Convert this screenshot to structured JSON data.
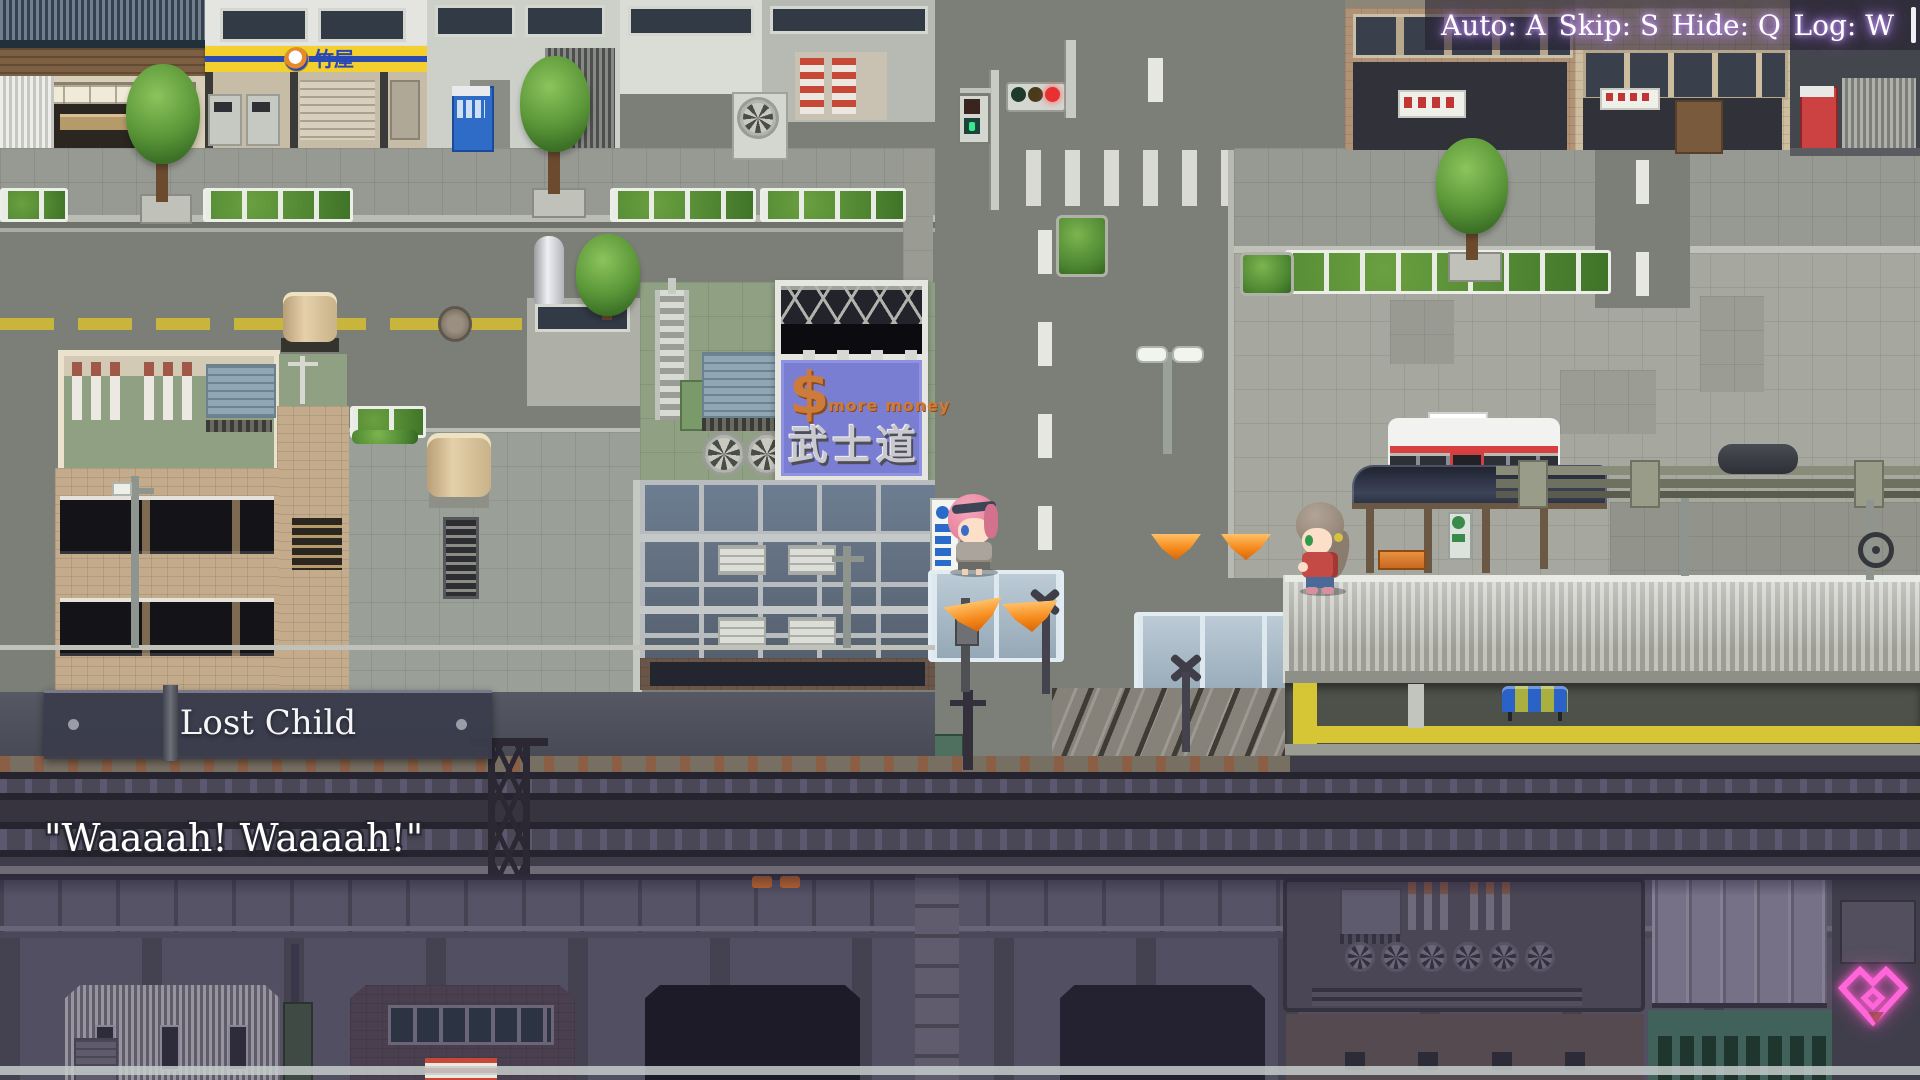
{
  "ui": {
    "quick_menu": {
      "items": [
        {
          "label": "Auto: A"
        },
        {
          "label": "Skip: S"
        },
        {
          "label": "Hide: Q"
        },
        {
          "label": "Log: W"
        }
      ]
    },
    "location_banner": {
      "title": "Lost Child"
    },
    "dialog": {
      "line": "\"Waaaah! Waaaah!\""
    },
    "continue_indicator": {
      "shape": "pink-heart-diamond",
      "color": "#ff66d9"
    }
  },
  "scene": {
    "billboard": {
      "dollar": "$",
      "tagline": "more money",
      "kanji": "武士道",
      "panel_color": "#7a7ed2",
      "text_color": "#cd7b3a"
    },
    "storefront_sign": {
      "text": "竹屋",
      "bg_color": "#f4d02e",
      "text_color": "#2847b8"
    },
    "path_markers": {
      "color": "#f58a1c",
      "count": 4
    },
    "characters": [
      {
        "name": "pink-haired-girl"
      },
      {
        "name": "lost-child-girl"
      }
    ],
    "station": {
      "tactile_line_color": "#d6c636",
      "traffic_light_state": "red"
    }
  },
  "colors": {
    "menu_glow": "#a97ae8",
    "banner_bg": "#3a3c4c",
    "road": "#7c7f77",
    "plaza": "#a6a89f",
    "tracks": "#403d4b"
  }
}
